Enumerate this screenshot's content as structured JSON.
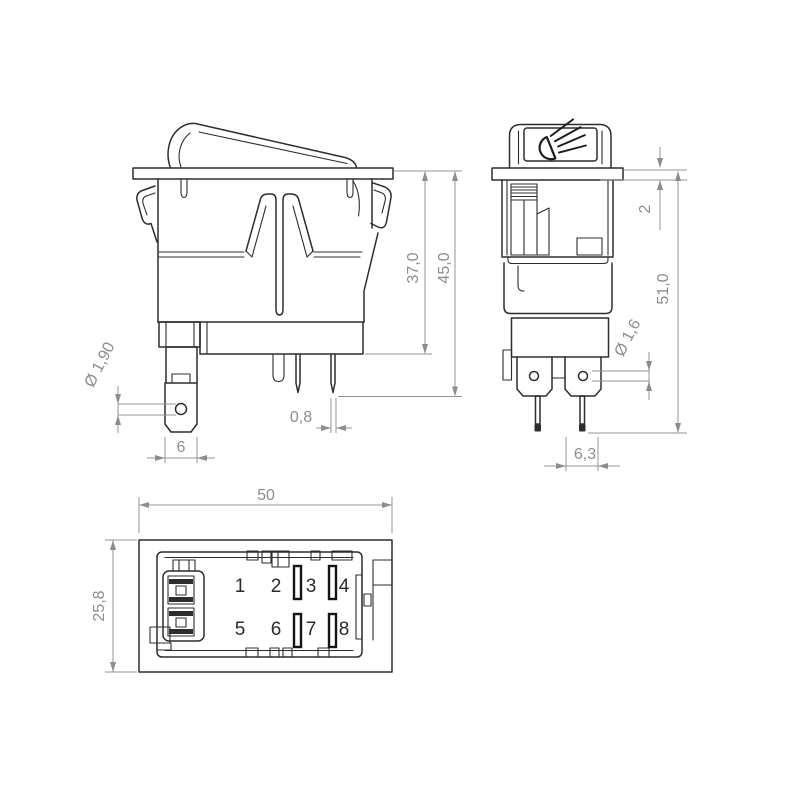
{
  "views": {
    "side": {
      "labels": {
        "body_height": "37,0",
        "total_height": "45,0",
        "hole_diameter": "Ø 1,90",
        "blade_width": "6",
        "pin_thickness": "0,8"
      }
    },
    "front": {
      "labels": {
        "flange_thickness": "2",
        "total_height": "51,0",
        "hole_diameter": "Ø 1,6",
        "terminal_spacing": "6,3"
      }
    },
    "bottom": {
      "labels": {
        "width": "50",
        "depth": "25,8"
      },
      "terminals": [
        "1",
        "2",
        "3",
        "4",
        "5",
        "6",
        "7",
        "8"
      ]
    }
  },
  "colors": {
    "line": "#2d2d2d",
    "dimension": "#8d8d8d",
    "background": "#ffffff"
  }
}
